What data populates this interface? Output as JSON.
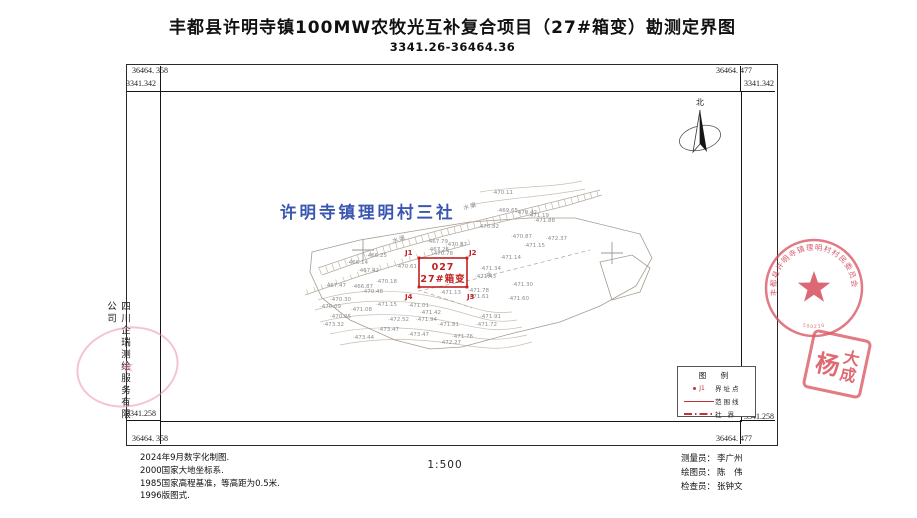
{
  "title": "丰都县许明寺镇100MW农牧光互补复合项目（27#箱变）勘测定界图",
  "subtitle": "3341.26-36464.36",
  "frame": {
    "corners": {
      "tl_x": "36464. 358",
      "tl_y": "3341.342",
      "tr_x": "36464. 477",
      "tr_y": "3341.342",
      "bl_x": "36464. 358",
      "bl_y": "3341.258",
      "br_x": "36464. 477",
      "br_y": "3341.258"
    }
  },
  "north_label": "北",
  "village_label": "许明寺镇理明村三社",
  "parcel": {
    "code": "027",
    "name": "27#箱变",
    "vertices": [
      {
        "label": "J1",
        "x": 405,
        "y": 255
      },
      {
        "label": "J2",
        "x": 469,
        "y": 255
      },
      {
        "label": "J3",
        "x": 467,
        "y": 299
      },
      {
        "label": "J4",
        "x": 405,
        "y": 299
      }
    ]
  },
  "map": {
    "water_labels": [
      {
        "t": "水渠",
        "x": 393,
        "y": 243,
        "r": -17
      },
      {
        "t": "水渠",
        "x": 464,
        "y": 210,
        "r": -16
      },
      {
        "t": "水",
        "x": 486,
        "y": 277,
        "r": 0
      }
    ],
    "grid_crosses": [
      [
        363,
        250
      ],
      [
        612,
        253
      ]
    ],
    "spot_heights": [
      {
        "v": "470.11",
        "x": 492,
        "y": 194
      },
      {
        "v": "469.65",
        "x": 497,
        "y": 212
      },
      {
        "v": "470.42",
        "x": 516,
        "y": 214
      },
      {
        "v": "471.19",
        "x": 528,
        "y": 217
      },
      {
        "v": "471.88",
        "x": 534,
        "y": 222
      },
      {
        "v": "470.82",
        "x": 478,
        "y": 228
      },
      {
        "v": "470.87",
        "x": 511,
        "y": 238
      },
      {
        "v": "472.37",
        "x": 546,
        "y": 240
      },
      {
        "v": "471.15",
        "x": 524,
        "y": 247
      },
      {
        "v": "471.14",
        "x": 500,
        "y": 259
      },
      {
        "v": "467.79",
        "x": 427,
        "y": 243
      },
      {
        "v": "470.87",
        "x": 446,
        "y": 246
      },
      {
        "v": "467.26",
        "x": 428,
        "y": 251
      },
      {
        "v": "466.25",
        "x": 366,
        "y": 257
      },
      {
        "v": "466.14",
        "x": 347,
        "y": 264
      },
      {
        "v": "467.42",
        "x": 358,
        "y": 272
      },
      {
        "v": "470.61",
        "x": 396,
        "y": 268
      },
      {
        "v": "470.78",
        "x": 432,
        "y": 255
      },
      {
        "v": "470.18",
        "x": 376,
        "y": 283
      },
      {
        "v": "467.47",
        "x": 325,
        "y": 287
      },
      {
        "v": "466.87",
        "x": 352,
        "y": 288
      },
      {
        "v": "470.48",
        "x": 362,
        "y": 293
      },
      {
        "v": "470.30",
        "x": 330,
        "y": 301
      },
      {
        "v": "470.09",
        "x": 320,
        "y": 308
      },
      {
        "v": "471.08",
        "x": 351,
        "y": 311
      },
      {
        "v": "471.15",
        "x": 376,
        "y": 306
      },
      {
        "v": "471.01",
        "x": 408,
        "y": 307
      },
      {
        "v": "470.05",
        "x": 330,
        "y": 318
      },
      {
        "v": "471.42",
        "x": 420,
        "y": 314
      },
      {
        "v": "471.94",
        "x": 416,
        "y": 321
      },
      {
        "v": "472.52",
        "x": 388,
        "y": 321
      },
      {
        "v": "473.32",
        "x": 323,
        "y": 326
      },
      {
        "v": "473.47",
        "x": 378,
        "y": 331
      },
      {
        "v": "473.44",
        "x": 353,
        "y": 339
      },
      {
        "v": "473.47",
        "x": 408,
        "y": 336
      },
      {
        "v": "471.81",
        "x": 438,
        "y": 326
      },
      {
        "v": "471.76",
        "x": 452,
        "y": 338
      },
      {
        "v": "472.27",
        "x": 440,
        "y": 344
      },
      {
        "v": "471.13",
        "x": 440,
        "y": 294
      },
      {
        "v": "471.34",
        "x": 480,
        "y": 270
      },
      {
        "v": "471.43",
        "x": 475,
        "y": 278
      },
      {
        "v": "471.78",
        "x": 468,
        "y": 292
      },
      {
        "v": "471.61",
        "x": 468,
        "y": 298
      },
      {
        "v": "471.30",
        "x": 512,
        "y": 286
      },
      {
        "v": "471.60",
        "x": 508,
        "y": 300
      },
      {
        "v": "471.91",
        "x": 480,
        "y": 318
      },
      {
        "v": "471.72",
        "x": 476,
        "y": 326
      }
    ]
  },
  "legend": {
    "title": "图 例",
    "items": [
      {
        "symbol": "point",
        "point_label": "J1",
        "label": "界址点"
      },
      {
        "symbol": "solid",
        "label": "范围线"
      },
      {
        "symbol": "dashdot",
        "label": "社 界"
      }
    ]
  },
  "company_vertical": "四川企瑞测绘服务有限公司",
  "stamps": {
    "round_text": "丰都县许明寺镇理明村村民委员会",
    "round_number": "500230",
    "square_char_1": "杨",
    "square_char_2": "大",
    "square_char_3": "成"
  },
  "notes": [
    "2024年9月数字化制图.",
    "2000国家大地坐标系.",
    "1985国家高程基准，等高距为0.5米.",
    "1996版图式."
  ],
  "scale_label": "1:500",
  "credits": [
    {
      "role": "测量员：",
      "name": "李广州"
    },
    {
      "role": "绘图员：",
      "name": "陈　伟"
    },
    {
      "role": "检查员：",
      "name": "张钟文"
    }
  ]
}
